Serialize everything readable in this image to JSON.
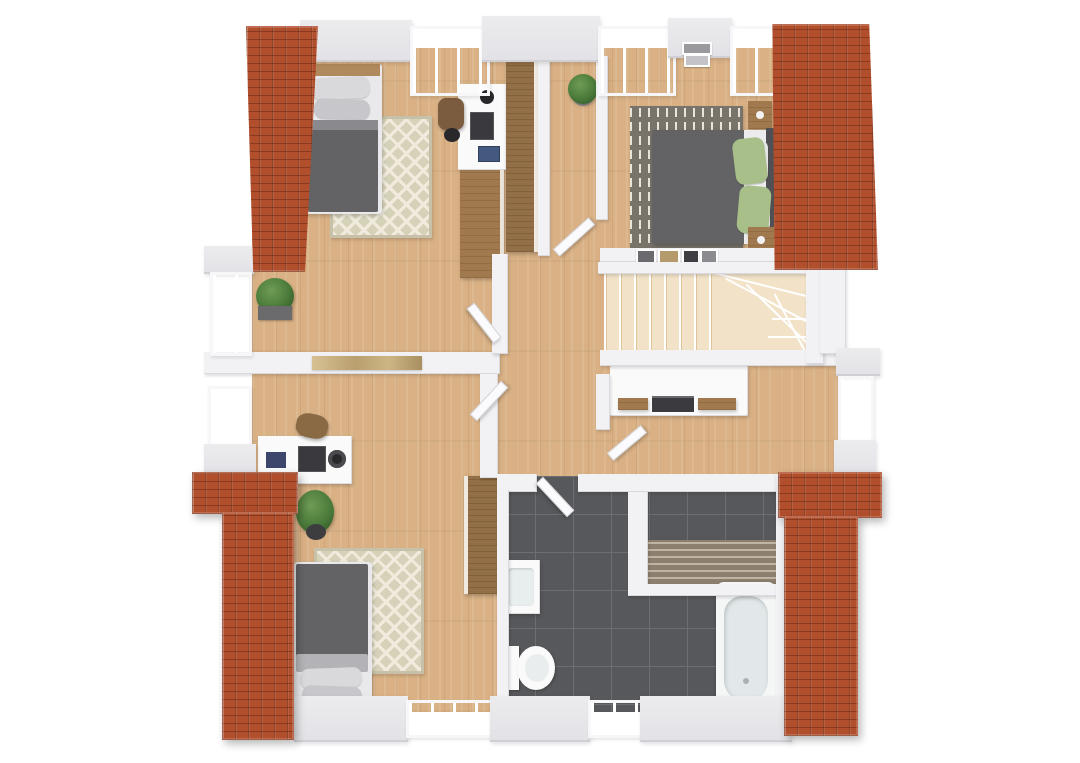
{
  "scene": {
    "kind": "3d-floor-plan-render",
    "view": "top-down orthographic render of an upper storey",
    "background_color": "#ffffff",
    "storey": "attic floor with four sloped terracotta roof sections at the corners"
  },
  "rooms": [
    {
      "id": "bedroom-top-left",
      "label": "Bedroom (top left)",
      "furniture": [
        "single bed with grey duvet and two grey pillows",
        "wooden headboard",
        "beige diamond-pattern rug",
        "white desk with lamp, monitor and books",
        "brown office chair",
        "low wooden sideboard",
        "tall wooden wardrobe"
      ]
    },
    {
      "id": "hallway-top",
      "label": "Upper hallway",
      "furniture": [
        "potted green plant"
      ]
    },
    {
      "id": "bedroom-top-right",
      "label": "Bedroom (top right)",
      "furniture": [
        "double bed with dark grey duvet and white sheet",
        "two green pillows",
        "grey rug with light dash pattern",
        "two wooden nightstands",
        "small picture frames on both walls"
      ]
    },
    {
      "id": "landing",
      "label": "Central landing / hallway",
      "furniture": [
        "five open white doors",
        "framed artwork on lower wall"
      ]
    },
    {
      "id": "staircase",
      "label": "Staircase",
      "furniture": [
        "winder staircase with pale wooden treads"
      ]
    },
    {
      "id": "dressing-room",
      "label": "Dressing room",
      "furniture": [
        "long white sideboard with wooden drawer fronts and dark tray"
      ]
    },
    {
      "id": "bedroom-bottom-left",
      "label": "Bedroom (bottom left)",
      "furniture": [
        "white desk with monitor, lamp and accessories",
        "leather satchel on floor",
        "potted green plant",
        "green diamond-pattern rug",
        "single bed with grey duvet and two pillows",
        "tall wooden wardrobe"
      ]
    },
    {
      "id": "bathroom",
      "label": "Bathroom",
      "furniture": [
        "dark grey floor tiles",
        "white washbasin cabinet",
        "toilet",
        "white bathtub with dark fixture",
        "slatted radiator bench"
      ]
    }
  ],
  "exterior": {
    "features": [
      "four terracotta-tiled roof slopes at the corners",
      "dormer windows on top, left, right and bottom walls",
      "boxwood planter on left balcony ledge",
      "white wall slabs and ledges"
    ]
  },
  "palette": {
    "wood": "#d9b185",
    "tile": "#57585b",
    "tileLine": "#6d6e72",
    "roof": "#b14e2c",
    "wall": "#f2f2f5",
    "slab": "#e2e2e6",
    "glassA": "#eef3f5",
    "glassB": "#dfe8ec",
    "stair": "#f2e2c8",
    "stairLine": "#dfc49b",
    "rugBase": "#d6d2ba",
    "rugPat": "#f0ebdc",
    "rugDashBase": "#78746c",
    "rugDash": "#e9e5d9",
    "bedDark": "#636366",
    "bedFrame": "#e9e9eb",
    "pillow": "#d9d9dc",
    "pillowGreen": "#a8bf8a",
    "furnWood": "#a1794e",
    "wardrobe": "#936f47",
    "plant": "#4a7a3a",
    "black": "#29292c",
    "white": "#fafafa",
    "art": "#c9b086",
    "radA": "#8d7f6e",
    "radB": "#beb5a5",
    "tub": "#f5f7f7",
    "tubInner": "#e2e8e9"
  }
}
